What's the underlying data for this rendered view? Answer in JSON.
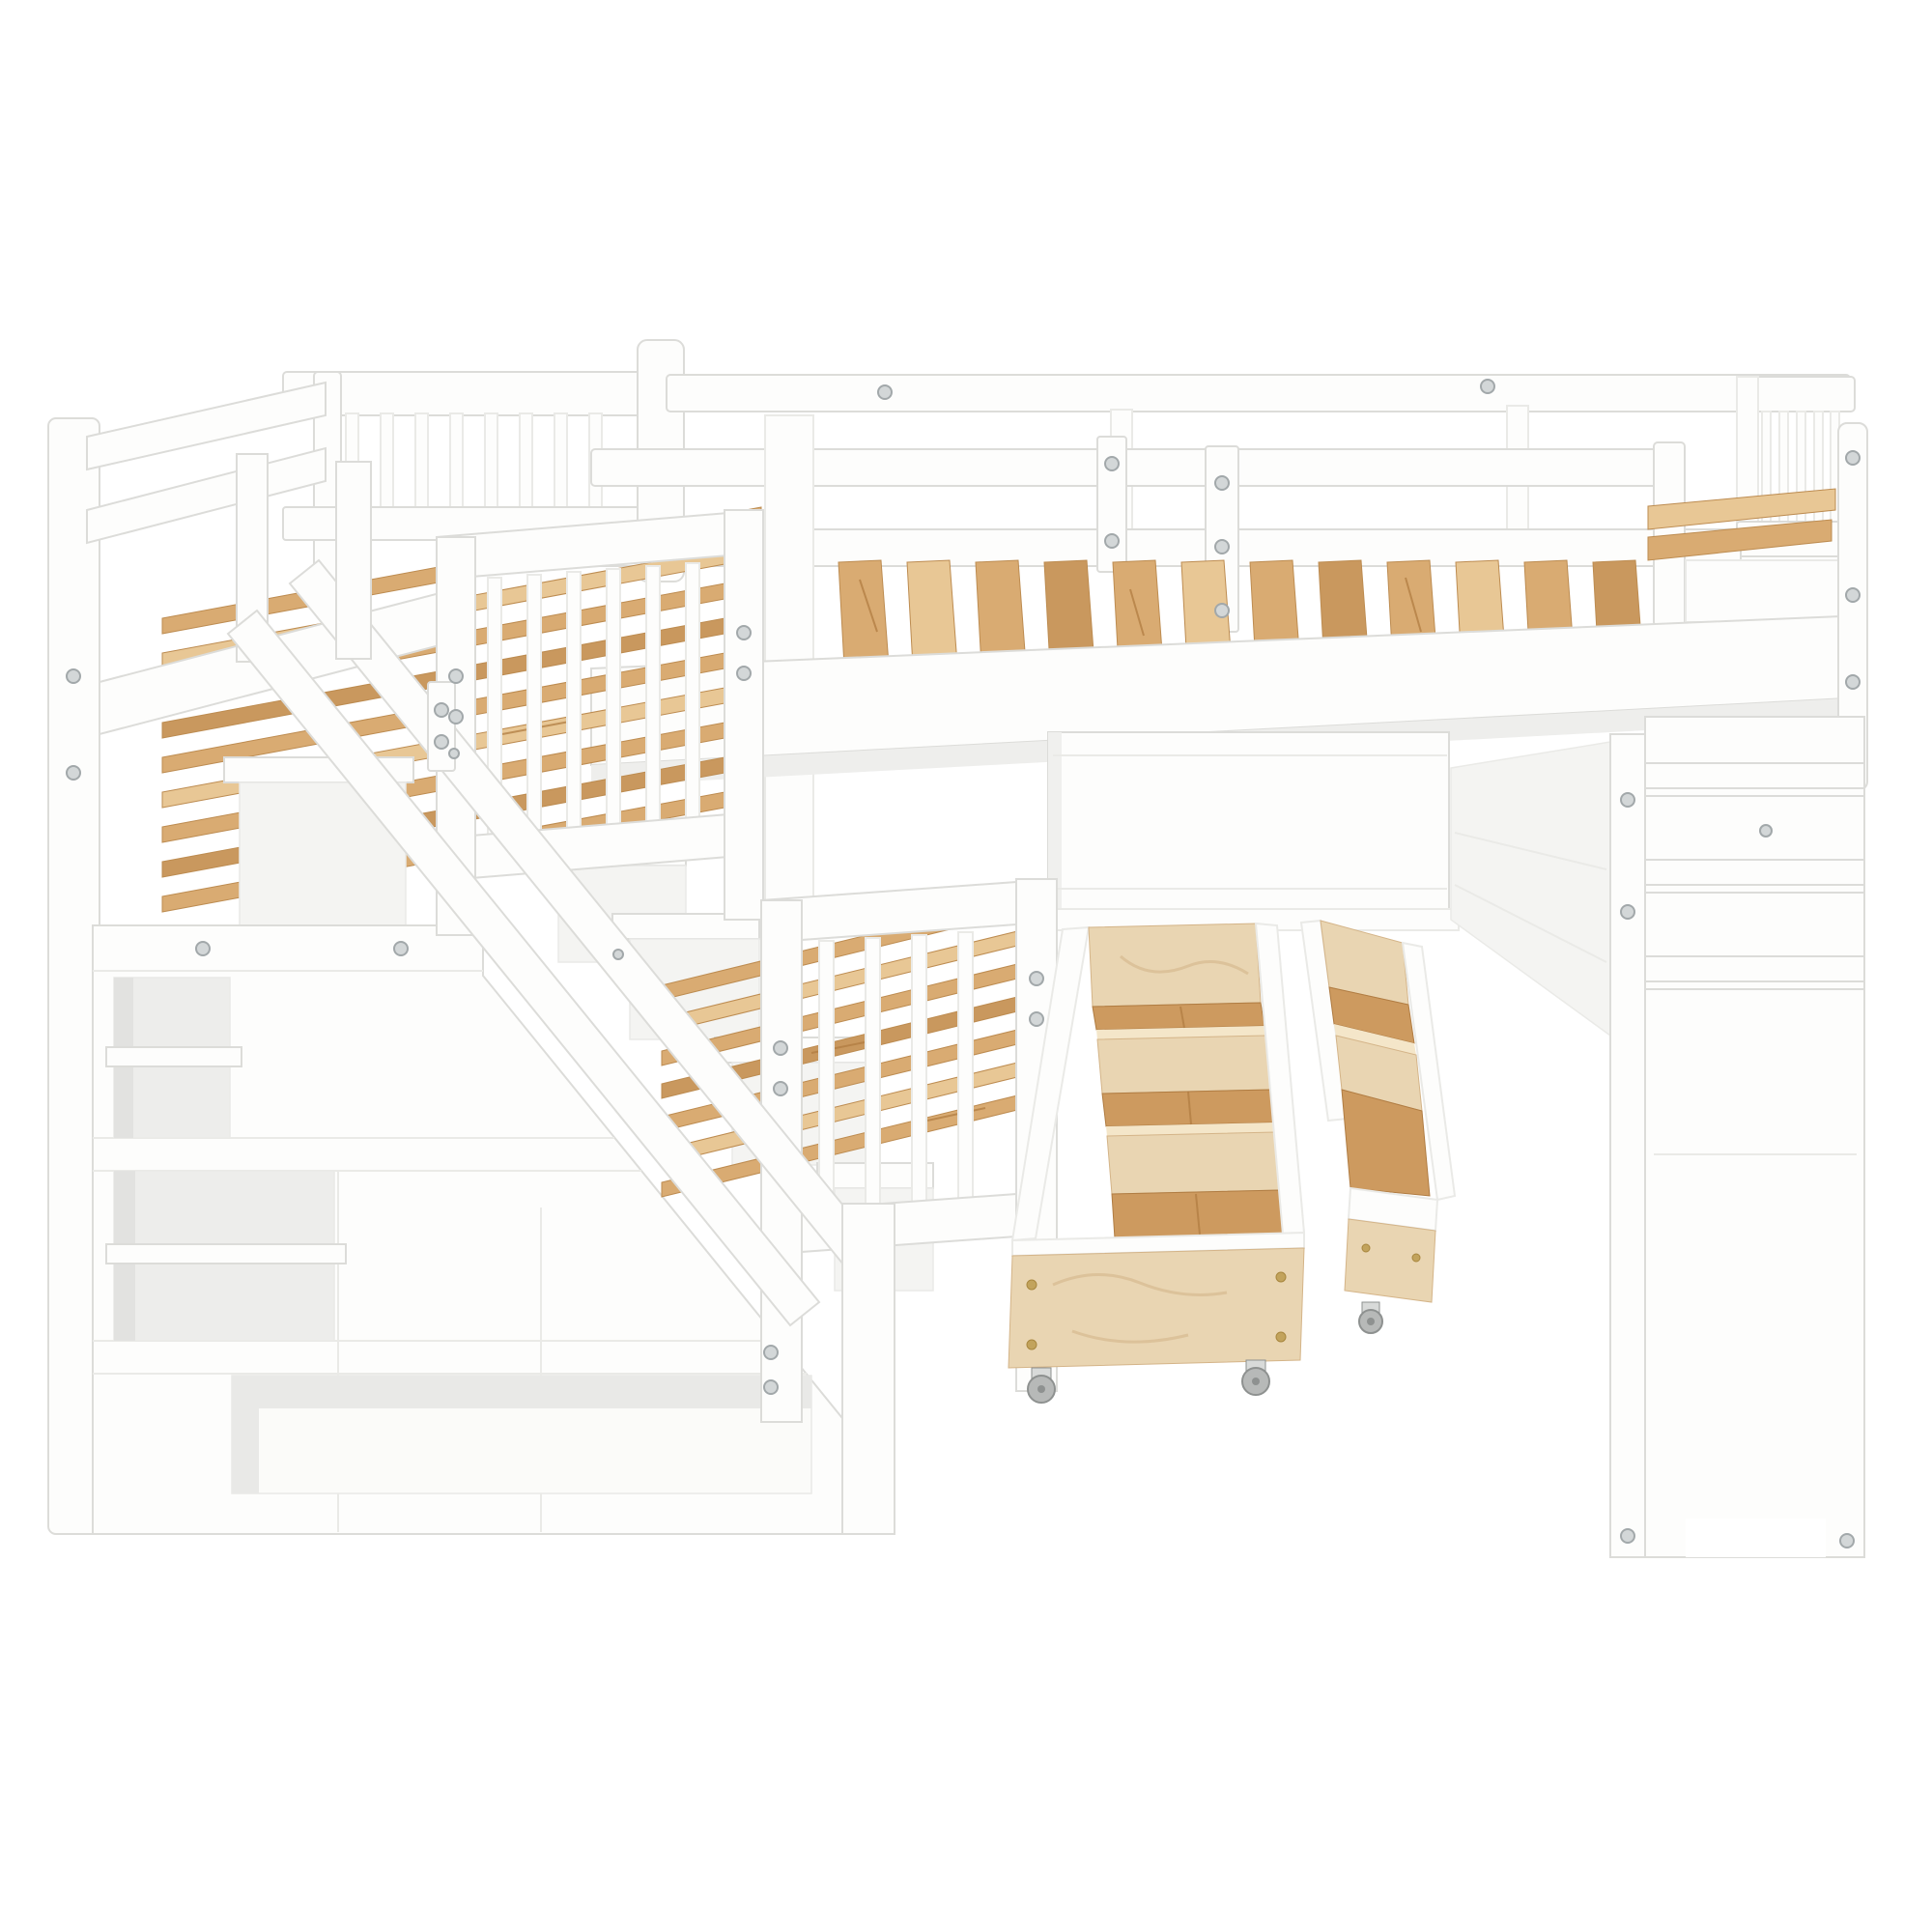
{
  "scene": {
    "type": "furniture product photo",
    "subject": "White wooden L-shaped bunk bed set: upper twin bed over storage staircase, loft bed with guardrails, lower bed, two rolling under-bed storage drawers, privacy panel and side shelf tower",
    "background": "#ffffff",
    "finish": "white painted solid wood with natural pine slats and plywood drawer boxes"
  },
  "palette": {
    "background": "#ffffff",
    "frame": "#fdfdfc",
    "frame_shade": "#f4f4f2",
    "recess": "#ededeb",
    "inner_shadow": "#e4e4e2",
    "outline": "#dcdcd9",
    "outline_soft": "#eaeae7",
    "wood": "#d9ab72",
    "wood_light": "#e8c795",
    "wood_dark": "#c9985e",
    "wood_edge": "#bd8c51",
    "ply": "#e9d5b2",
    "ply_light": "#f4e6c9",
    "ply_edge": "#d4b488",
    "ply_swirl": "#d8bd94",
    "drawer_floor": "#cd9a5f",
    "drawer_grain": "#b07c42",
    "caster": "#b7b9b8",
    "caster_dark": "#8e9190",
    "caster_mount": "#d8dad9",
    "screw": "#d3d7d8",
    "screw_ring": "#a2a8aa",
    "brass": "#c2a35c"
  },
  "components": {
    "loft_bed": {
      "label": "Loft bed with long guardrails, pine slats and spindle headboard",
      "slat_count": 12
    },
    "twin_bed": {
      "label": "Upper twin bed over staircase with spindle headboard and footboard",
      "headboard_spindles": 8,
      "footboard_spindles": 6
    },
    "lower_bed": {
      "label": "Lower bed with spindle footboard and pine slats",
      "footboard_spindles": 4,
      "slat_count": 7
    },
    "staircase": {
      "label": "Storage staircase with handrail, two open shelves and bottom cubby",
      "steps": 4,
      "open_shelves": 2
    },
    "drawers": {
      "label": "Two pulled-out plywood storage drawers with dividers on caster wheels",
      "count": 2,
      "casters": 3
    },
    "privacy_panel": {
      "label": "Under-loft privacy panel"
    },
    "shelf_tower": {
      "label": "Side shelf tower with three shelf rungs and cut-out feet",
      "rungs": 3
    }
  }
}
